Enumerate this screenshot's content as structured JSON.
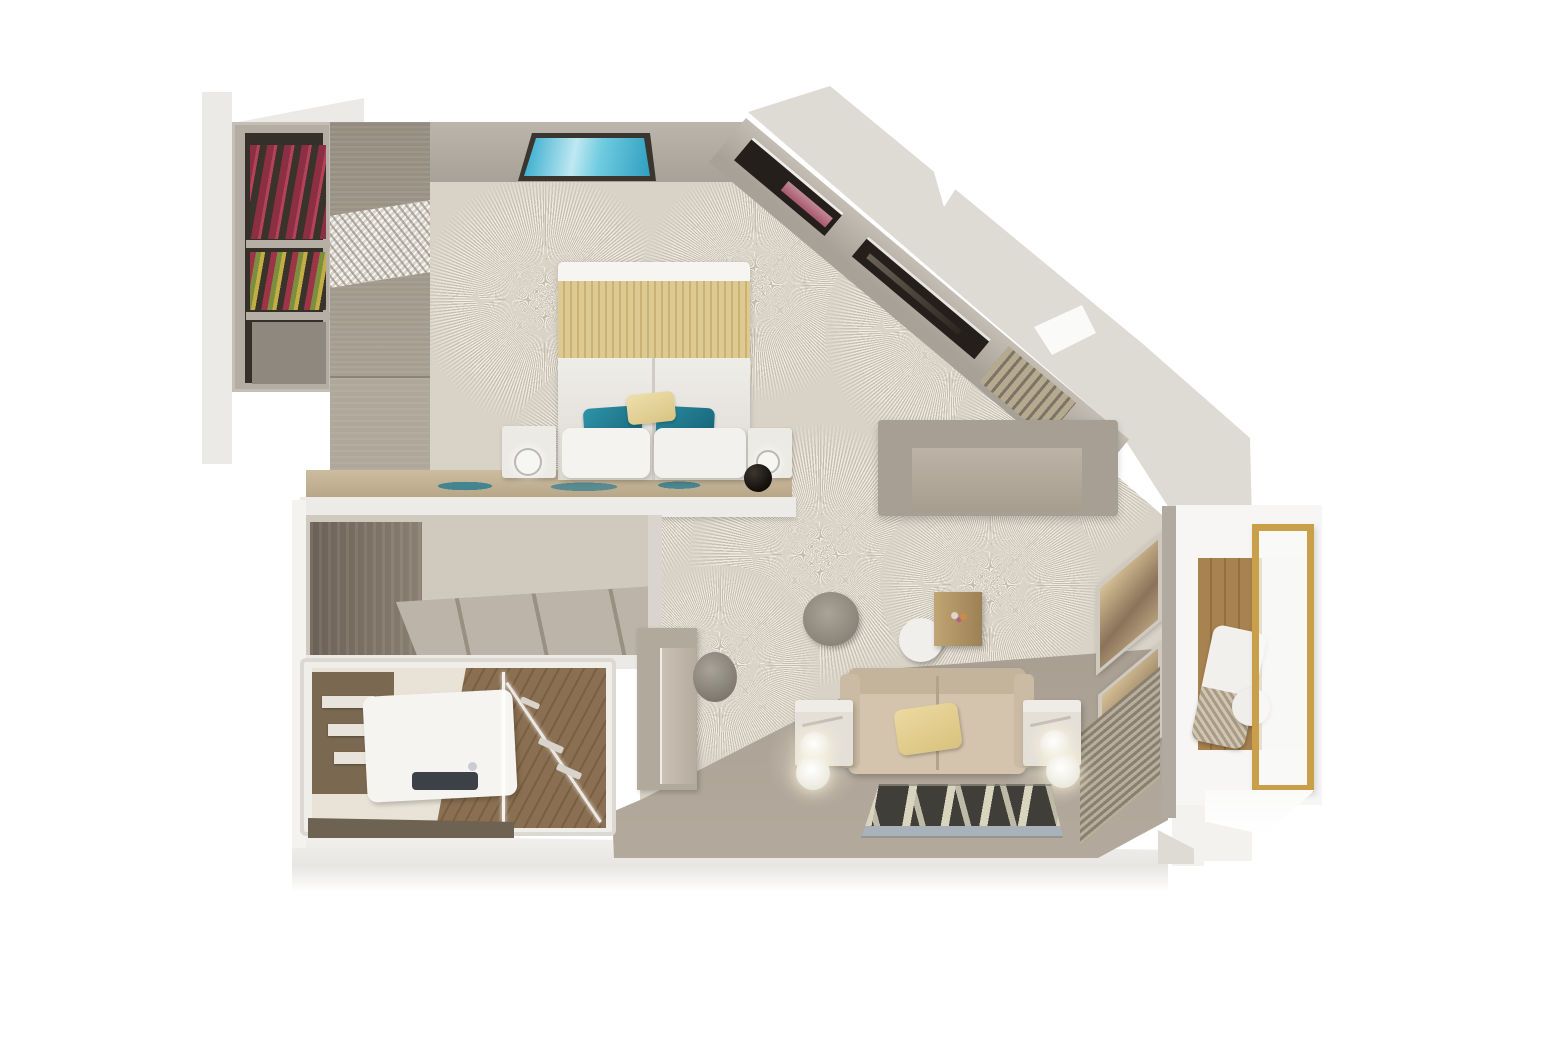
{
  "page": {
    "background": "#ffffff"
  },
  "palette": {
    "bg": "#ffffff",
    "ext": "#dedbd5",
    "ext-light": "#eceae6",
    "wall": "#a8a197",
    "wall-light": "#bcb5ab",
    "carpet": "#d8d2c7",
    "carpet-ray": "#c5bdae",
    "carpet-stroke": "#efebe2",
    "floor": "#a89e91",
    "wood-panel": "#a89f93",
    "closet-frame": "#b3ada4",
    "closet-dark": "#342f29",
    "bed-white": "#f0eeea",
    "bed-gold": "#d9c58d",
    "teal": "#1e7e95",
    "ledge-wood": "#b5a586",
    "sofa": "#d4c4ad",
    "desk": "#a79f94",
    "rug-dark": "#3f3e39",
    "rug-light": "#d9d4bd",
    "rug-band": "#a9b2ba",
    "balcony-wood": "#a8824f",
    "gold": "#c99f4a",
    "bath-wall": "#e9e2d6",
    "bath-floor": "#8a6f52",
    "window-dark": "#241f1a",
    "maroon": "#a8596c",
    "screen-teal": "#2fa9cc"
  },
  "scene": {
    "type": "3d-floorplan-render",
    "rooms": [
      "bedroom",
      "living-area",
      "entry-hall",
      "bathroom",
      "balcony"
    ],
    "objects": {
      "bedroom": [
        "wardrobe-with-clothes",
        "wall-screen",
        "double-bed",
        "gold-runner",
        "teal-pillows",
        "nightstands",
        "half-wall-console",
        "sunburst-carpet",
        "diagonal-window-wall"
      ],
      "living-area": [
        "desk",
        "round-ottoman",
        "round-side-table",
        "wood-cube-table",
        "sofa",
        "marble-side-tables",
        "floor-lamps",
        "leaf-pattern-rug",
        "tv-cabinet",
        "stool",
        "balcony-door"
      ],
      "bathroom": [
        "towel-shelf",
        "vanity-sink",
        "shower-glass",
        "wood-floor"
      ],
      "balcony": [
        "wood-deck",
        "lounge-chair",
        "round-table",
        "gold-glass-railing"
      ]
    }
  }
}
